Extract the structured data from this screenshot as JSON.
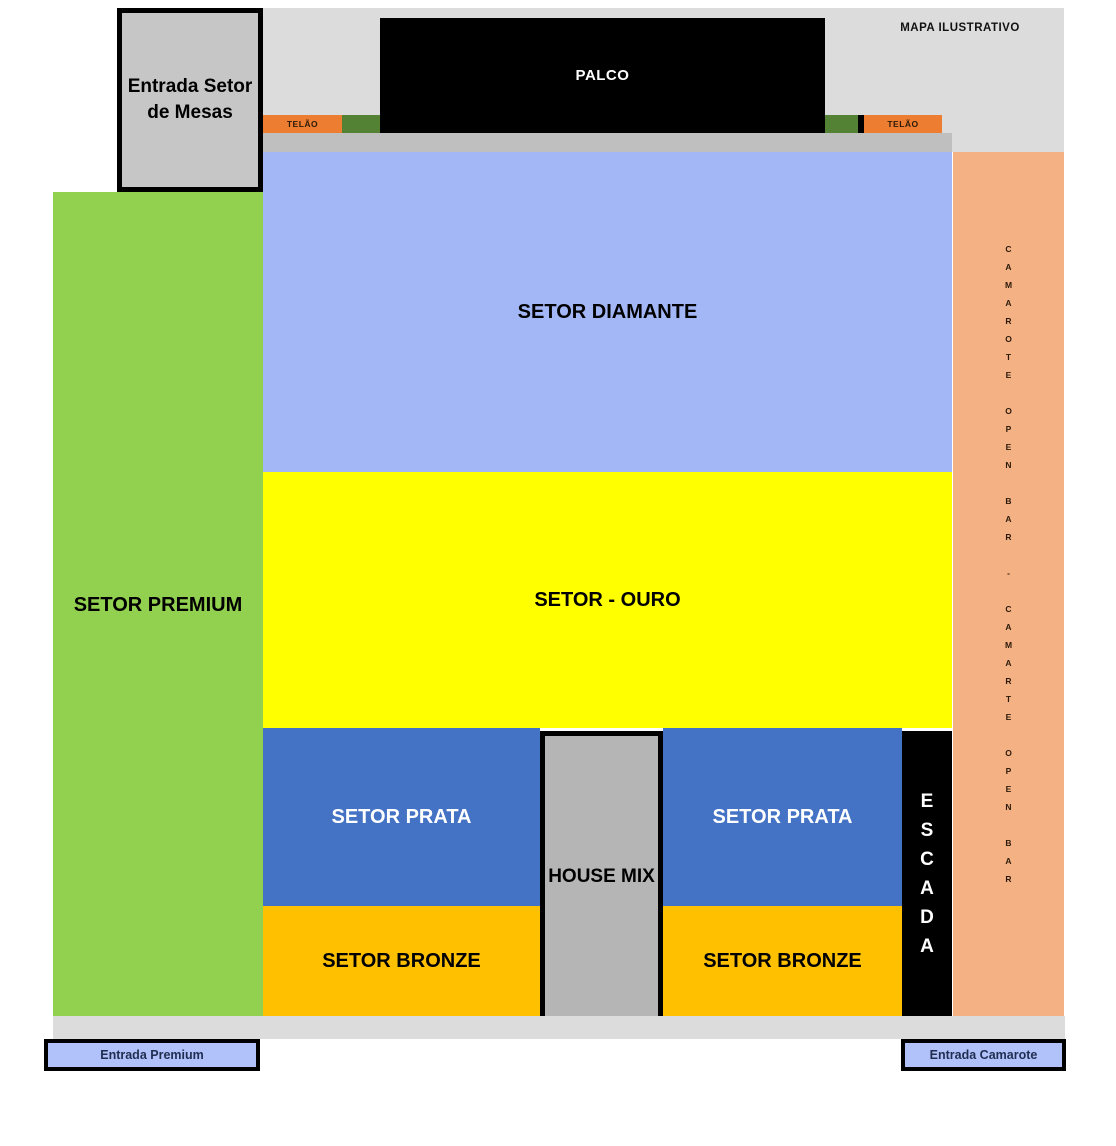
{
  "note": "MAPA ILUSTRATIVO",
  "stage": {
    "label": "PALCO"
  },
  "screens": {
    "left_label": "TELÃO",
    "right_label": "TELÃO"
  },
  "sectors": {
    "diamante": {
      "label": "SETOR DIAMANTE",
      "color": "#a3b7f7"
    },
    "ouro": {
      "label": "SETOR - OURO",
      "color": "#ffff00"
    },
    "premium": {
      "label": "SETOR PREMIUM",
      "color": "#92d050"
    },
    "prata_left": {
      "label": "SETOR PRATA",
      "color": "#4472c4"
    },
    "prata_right": {
      "label": "SETOR PRATA",
      "color": "#4472c4"
    },
    "bronze_left": {
      "label": "SETOR BRONZE",
      "color": "#ffc000"
    },
    "bronze_right": {
      "label": "SETOR BRONZE",
      "color": "#ffc000"
    },
    "house_mix": {
      "label": "HOUSE MIX",
      "color": "#b5b5b5"
    },
    "escada": {
      "label": "ESCADA",
      "color": "#000000"
    },
    "camarote": {
      "label": "CAMAROTE OPEN BAR - CAMARTE OPEN BAR",
      "color": "#f4b183"
    }
  },
  "entrances": {
    "mesas": {
      "label": "Entrada Setor de Mesas"
    },
    "premium": {
      "label": "Entrada Premium"
    },
    "camarote": {
      "label": "Entrada Camarote"
    }
  }
}
